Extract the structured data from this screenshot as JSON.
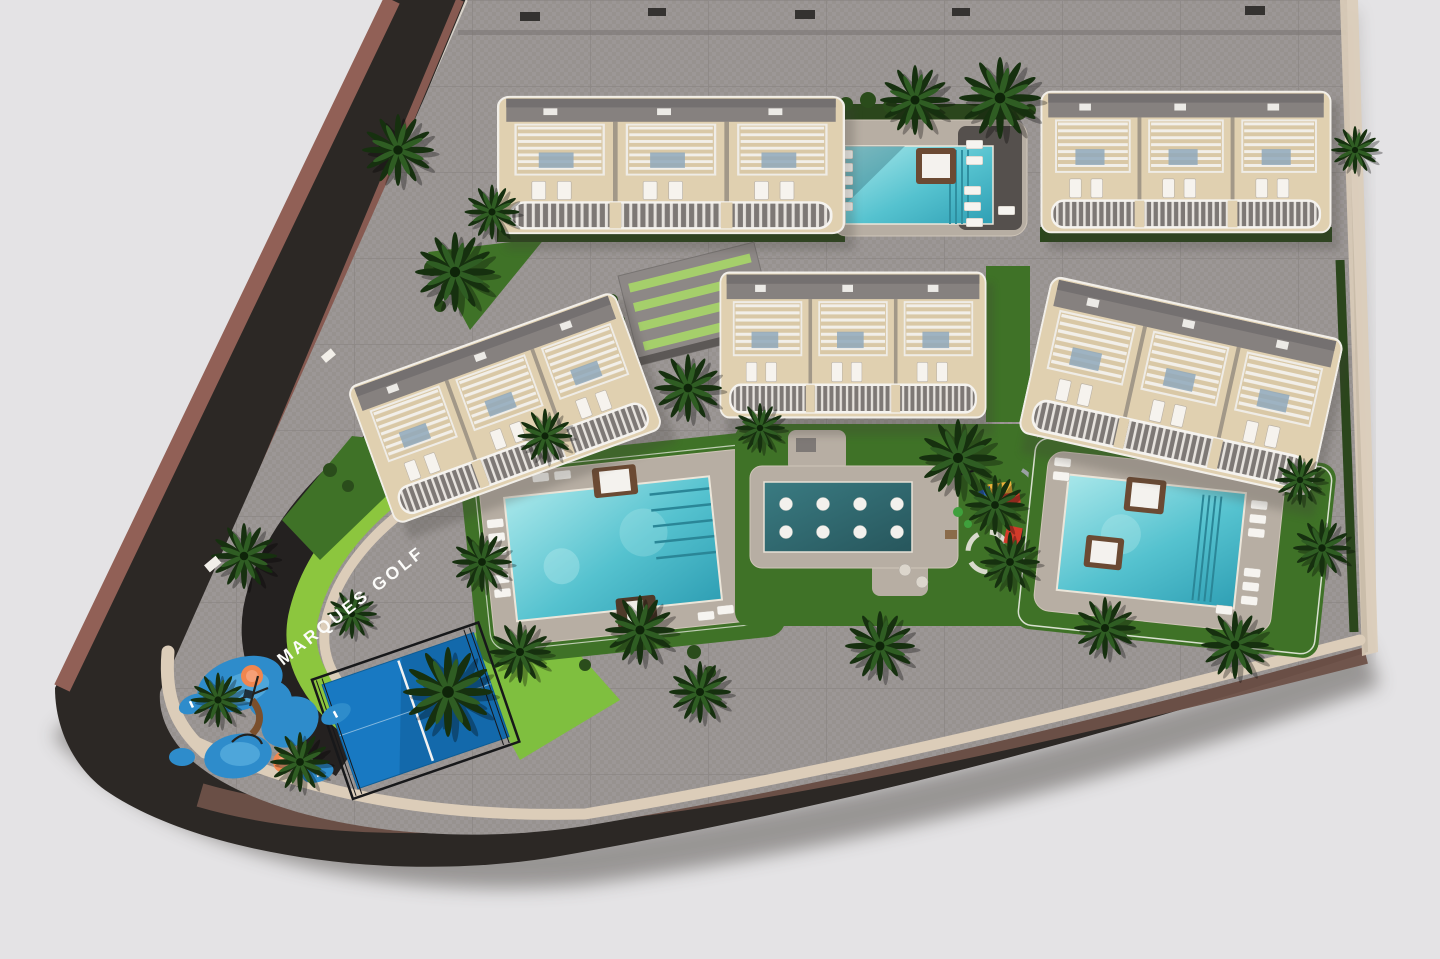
{
  "scene": {
    "type": "aerial-3d-site-plan-render",
    "street_label": "MARQUES GOLF"
  },
  "colors": {
    "background": "#e4e3e5",
    "asphalt": "#2c2825",
    "asphalt_dark": "#242120",
    "sidewalk_brown": "#916056",
    "sidewalk_brown_dark": "#6e5148",
    "sidewalk_beige": "#dccdb9",
    "paving": "#9c9796",
    "grass": "#3f7227",
    "grass_bright": "#8cc63e",
    "lawn_light": "#7fbf3f",
    "hedge": "#2b461c",
    "building_beige": "#e0d0b0",
    "building_gray": "#86817f",
    "trim_white": "#f5f3ef",
    "pool_light": "#a8e7ea",
    "pool_mid": "#55c2cf",
    "pool_deep": "#2f9fb4",
    "lap_pool": "#2e666d",
    "deck_beige": "#b7aea3",
    "deck_dark": "#55504d",
    "court_blue": "#1879c2",
    "play_blue": "#2e8ccb",
    "play_orange": "#f0864f",
    "daybed_wood": "#6b4a33",
    "palm_dark": "#16300f",
    "palm_mid": "#2f5d23",
    "shadow": "#4d4944"
  }
}
